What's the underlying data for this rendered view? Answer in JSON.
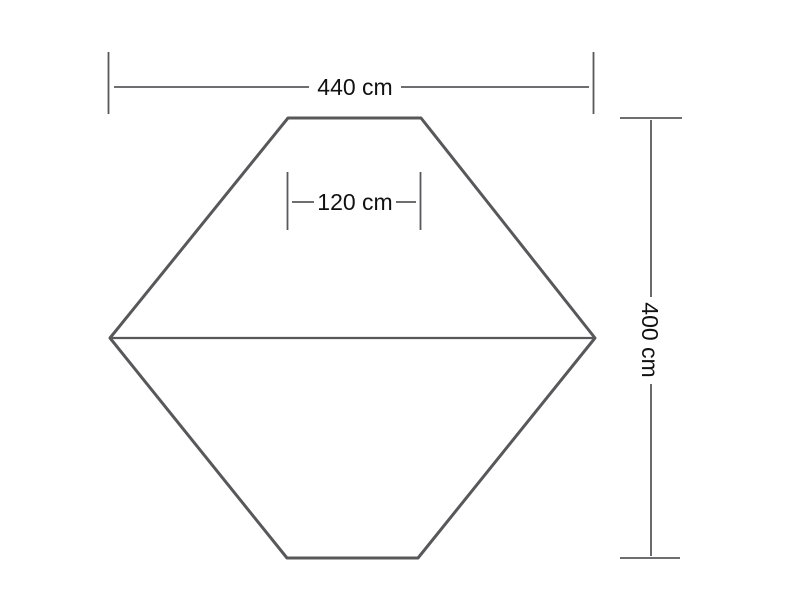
{
  "diagram": {
    "kind": "dimensioned-outline-drawing",
    "shape": "hexagon-with-center-seam",
    "dimensions": {
      "width": {
        "label": "440 cm",
        "value_cm": 440
      },
      "top_edge": {
        "label": "120 cm",
        "value_cm": 120
      },
      "height": {
        "label": "400 cm",
        "value_cm": 400
      }
    },
    "colors": {
      "outline": "#58585a",
      "dimension_line": "#59595b",
      "text": "#111111",
      "background": "#ffffff"
    }
  }
}
